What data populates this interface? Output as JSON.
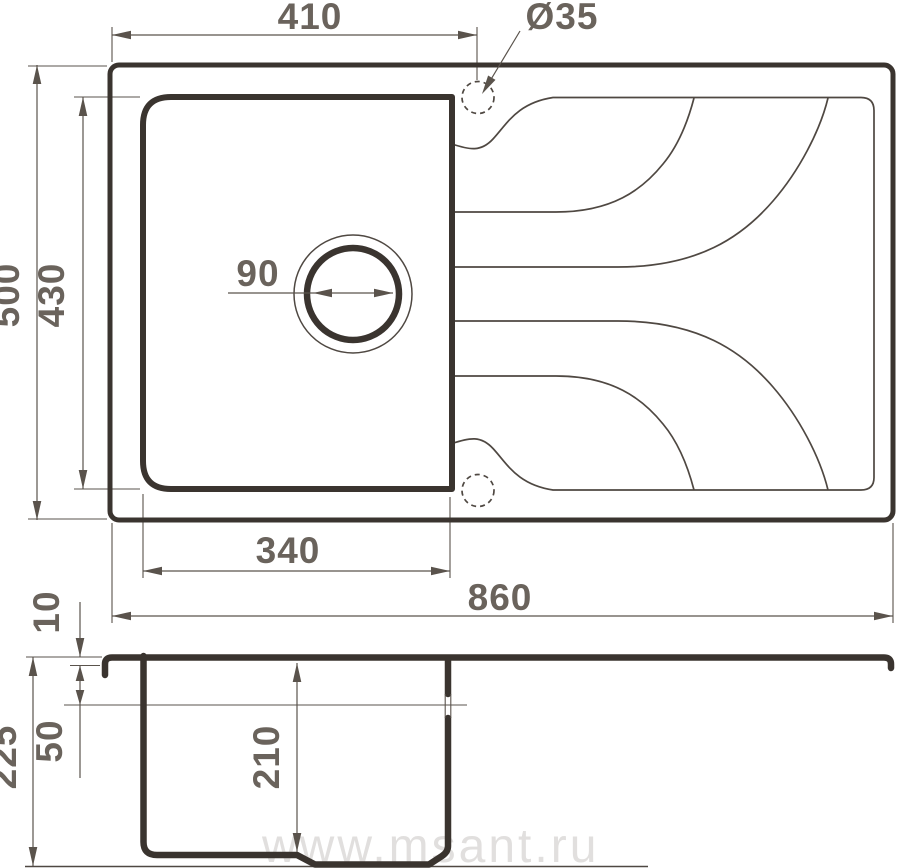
{
  "drawing": {
    "subject": "kitchen-sink-dimension-drawing",
    "watermark": "www.msant.ru",
    "colors": {
      "outline": "#3a342f",
      "thin_line": "#4f4842",
      "dimension": "#5a534c",
      "text": "#6a635c",
      "watermark": "#d7d5d3",
      "background": "#ffffff"
    },
    "top_view": {
      "bowl_width_top": "410",
      "faucet_hole_diameter": "Ø35",
      "overall_depth": "500",
      "bowl_depth": "430",
      "drain_diameter": "90",
      "bowl_width_bottom": "340",
      "overall_width": "860"
    },
    "section_view": {
      "rim_thickness": "10",
      "rim_offset_depth": "50",
      "overall_height": "225",
      "bowl_inner_depth": "210"
    }
  }
}
